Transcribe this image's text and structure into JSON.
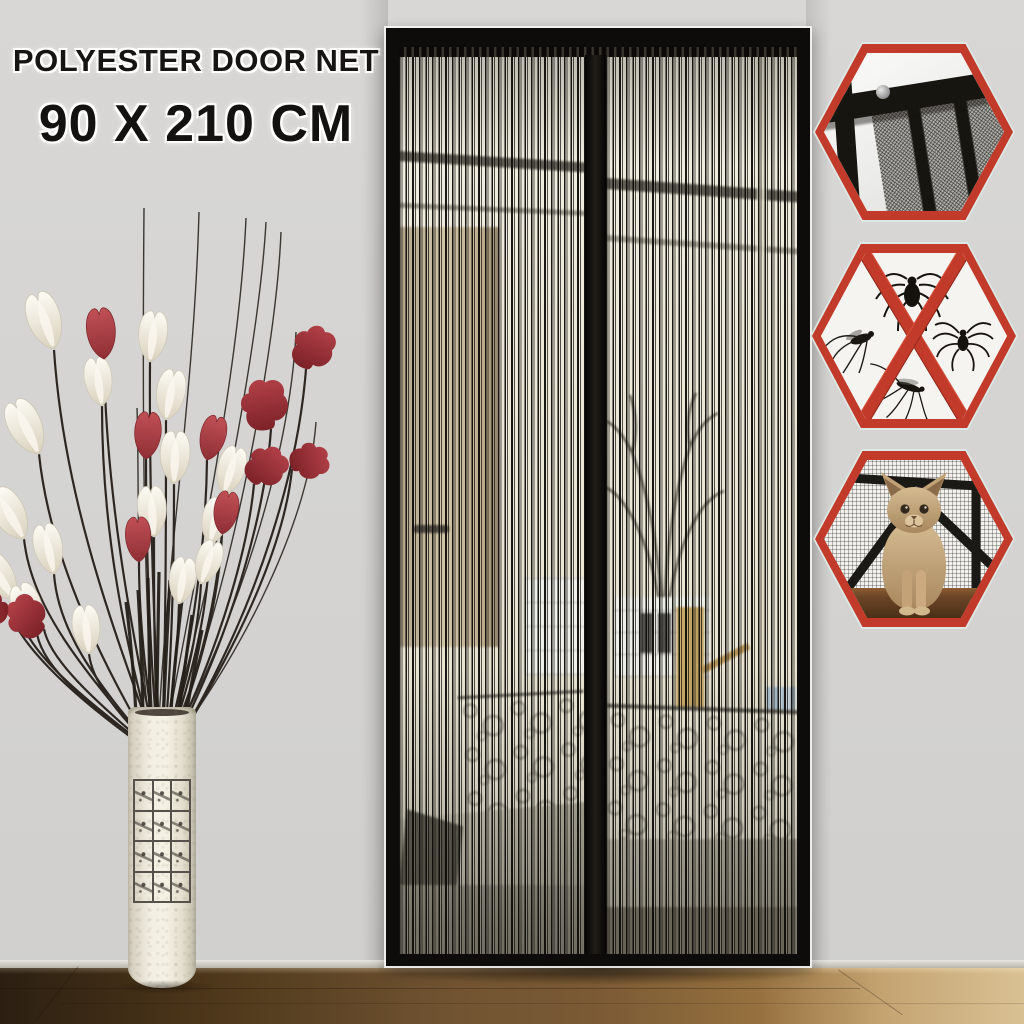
{
  "title": {
    "line1": "POLYESTER DOOR NET",
    "line2": "90 X 210 CM"
  },
  "door": {
    "type": "magnetic mesh door curtain",
    "panels": 2,
    "magnetic_center_strip": true,
    "frame_color": "#0d0c0a",
    "mesh_base_color": "#e9e4d4"
  },
  "feature_badges": [
    {
      "id": "mesh-corner-closeup",
      "icon": "mesh-corner-photo-icon",
      "border_color": "#c23a29",
      "rim_color": "#dde8e5"
    },
    {
      "id": "blocks-insects",
      "icon": "no-insects-icon",
      "border_color": "#c23a29",
      "rim_color": "#dde8e5",
      "insect_icons": [
        "spider-icon",
        "fly-icon",
        "spider-icon",
        "mosquito-icon"
      ],
      "cross_color": "#c23a29"
    },
    {
      "id": "pet-friendly",
      "icon": "cat-photo-icon",
      "border_color": "#c23a29",
      "rim_color": "#dde8e5"
    }
  ],
  "decor": {
    "flowers": {
      "red": "#a63a3e",
      "white": "#f2eee4",
      "stem": "#2e2721"
    },
    "vase": {
      "color": "#f1ecdf",
      "label_grid": {
        "rows": 4,
        "cols": 3,
        "cell_icon": "doodle-icon"
      }
    }
  },
  "colors": {
    "wall": "#d5d4d2",
    "accent_red": "#c23a29",
    "title_text": "#171513",
    "floor_left": "#44301b",
    "floor_right": "#d9c194"
  }
}
